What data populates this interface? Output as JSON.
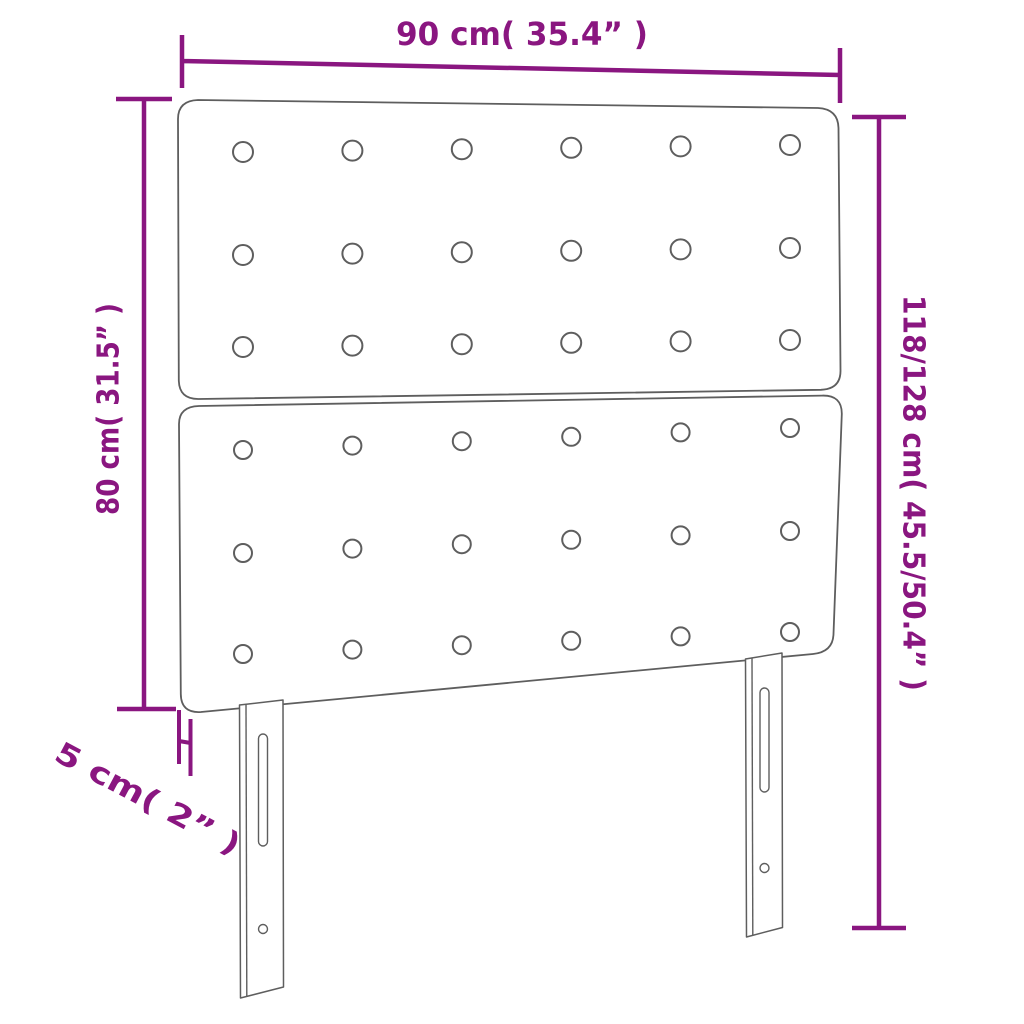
{
  "diagram_title": "headboard-dimension-diagram",
  "colors": {
    "dimension": "#8a1680",
    "outline": "#5e5e5e",
    "background": "#ffffff"
  },
  "labels": {
    "width": "90 cm( 35.4” )",
    "height_left": "80 cm( 31.5” )",
    "height_right": "118/128 cm( 45.5/50.4” )",
    "depth": "5 cm( 2” )"
  },
  "dimensions": {
    "width_cm": 90,
    "width_inch": 35.4,
    "panel_height_cm": 80,
    "panel_height_inch": 31.5,
    "total_height_cm_min": 118,
    "total_height_cm_max": 128,
    "total_height_inch_min": 45.5,
    "total_height_inch_max": 50.4,
    "depth_cm": 5,
    "depth_inch": 2
  },
  "headboard": {
    "panel_count": 2,
    "leg_count": 2,
    "leg_features": [
      "adjustment-slot",
      "screw-hole"
    ],
    "tufting": {
      "upper": {
        "rows": 3,
        "cols": 6,
        "x_start": 243,
        "x_end": 790,
        "row_y": [
          152,
          255,
          347
        ],
        "row_tilt": -7,
        "radius": 10
      },
      "lower": {
        "rows": 3,
        "cols": 6,
        "x_start": 243,
        "x_end": 790,
        "row_y": [
          450,
          553,
          654
        ],
        "row_tilt": -22,
        "radius": 9
      }
    }
  }
}
